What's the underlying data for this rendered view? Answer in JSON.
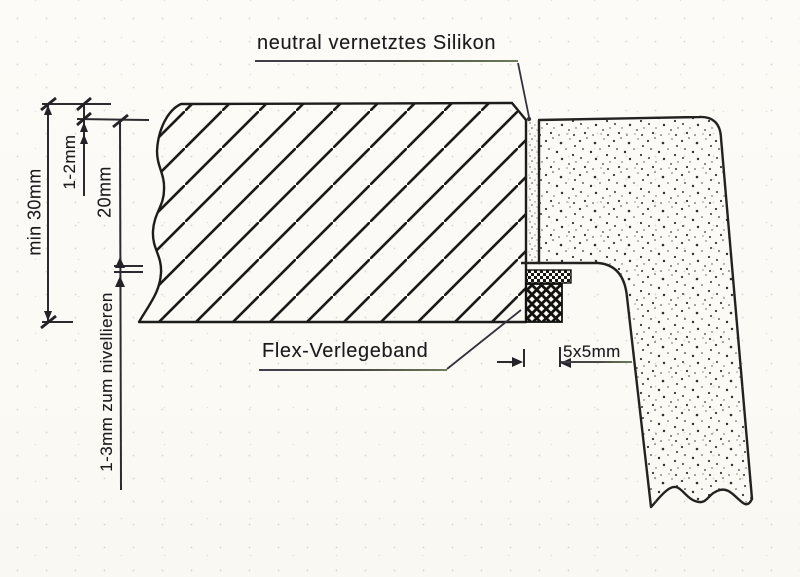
{
  "diagram": {
    "callouts": {
      "silicone": "neutral vernetztes Silikon",
      "tape": "Flex-Verlegeband"
    },
    "dimensions": {
      "slab_thickness": "min 30mm",
      "top_offset": "1-2mm",
      "joint_depth": "20mm",
      "leveling": "1-3mm zum nivellieren",
      "tape_size": "5x5mm"
    },
    "colors": {
      "paper": "#fbfaf5",
      "ink": "#222222",
      "underline_tint": "#6d7b5c"
    }
  }
}
